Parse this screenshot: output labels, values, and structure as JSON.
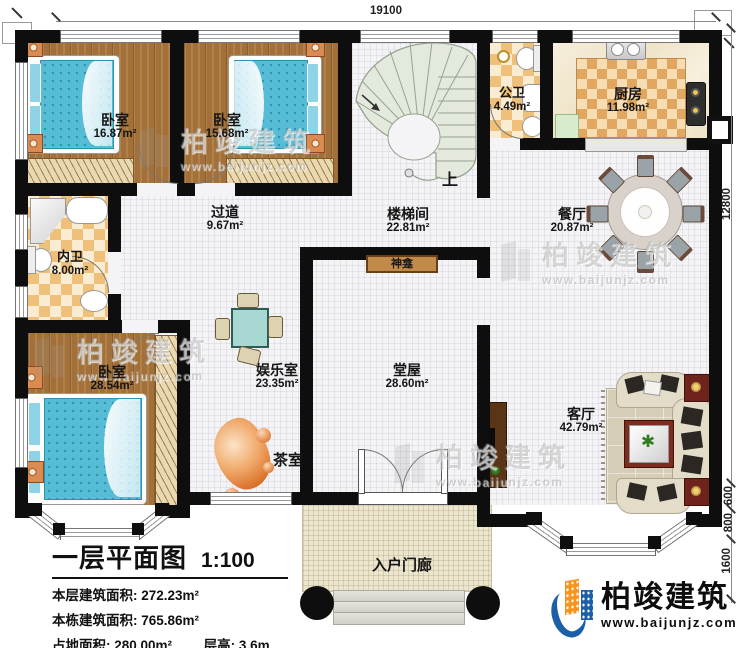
{
  "plan": {
    "title": "一层平面图",
    "scale": "1:100",
    "stats": [
      {
        "label": "本层建筑面积:",
        "value": "272.23m²"
      },
      {
        "label": "本栋建筑面积:",
        "value": "765.86m²"
      },
      {
        "label": "占地面积:",
        "value": "280.00m²"
      },
      {
        "label": "层高:",
        "value": "3.6m"
      }
    ]
  },
  "dimensions": {
    "top": "19100",
    "right_main": "12800",
    "right_600": "600",
    "right_800": "800",
    "right_1600": "1600"
  },
  "rooms": {
    "bedroom1": {
      "name": "卧室",
      "area": "16.87m²"
    },
    "bedroom2": {
      "name": "卧室",
      "area": "15.68m²"
    },
    "stairwell": {
      "name": "楼梯间",
      "area": "22.81m²"
    },
    "public_bath": {
      "name": "公卫",
      "area": "4.49m²"
    },
    "kitchen": {
      "name": "厨房",
      "area": "11.98m²"
    },
    "dining": {
      "name": "餐厅",
      "area": "20.87m²"
    },
    "hallway": {
      "name": "过道",
      "area": "9.67m²"
    },
    "private_bath": {
      "name": "内卫",
      "area": "8.00m²"
    },
    "bedroom3": {
      "name": "卧室",
      "area": "28.54m²"
    },
    "entertainment": {
      "name": "娱乐室",
      "area": "23.35m²"
    },
    "main_hall": {
      "name": "堂屋",
      "area": "28.60m²"
    },
    "living": {
      "name": "客厅",
      "area": "42.79m²"
    },
    "tea_room": {
      "name": "茶室"
    },
    "porch": {
      "name": "入户门廊"
    },
    "shrine": {
      "name": "神龛"
    }
  },
  "stairs": {
    "up_label": "上"
  },
  "brand": {
    "name": "柏竣建筑",
    "url": "www.baijunjz.com",
    "blue": "#1b5fa8",
    "orange": "#f7941d"
  },
  "watermark": {
    "name": "柏竣建筑",
    "url": "www.baijunjz.com"
  }
}
